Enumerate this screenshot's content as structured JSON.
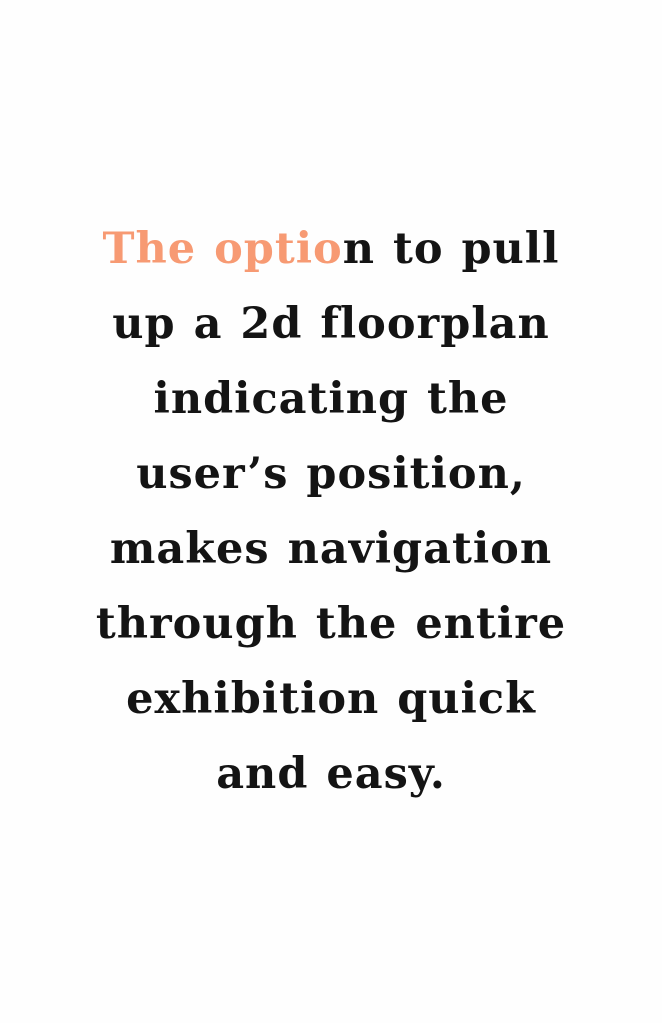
{
  "page": {
    "background": "#fefefe"
  },
  "quote": {
    "text_color": "#141414",
    "highlight_color": "#f79a73",
    "full_text": "The option to pull up a 2d floorplan indicating the user’s position, makes navigation through the entire exhibition quick and easy.",
    "highlighted_fragment": "The optio",
    "lines": [
      {
        "highlight": "The optio",
        "rest": "n to pull"
      },
      {
        "text": "up a 2d floorplan"
      },
      {
        "text": "indicating the"
      },
      {
        "text": "user’s position,"
      },
      {
        "text": "makes navigation"
      },
      {
        "text": "through the entire"
      },
      {
        "text": "exhibition quick"
      },
      {
        "text": "and easy."
      }
    ]
  }
}
